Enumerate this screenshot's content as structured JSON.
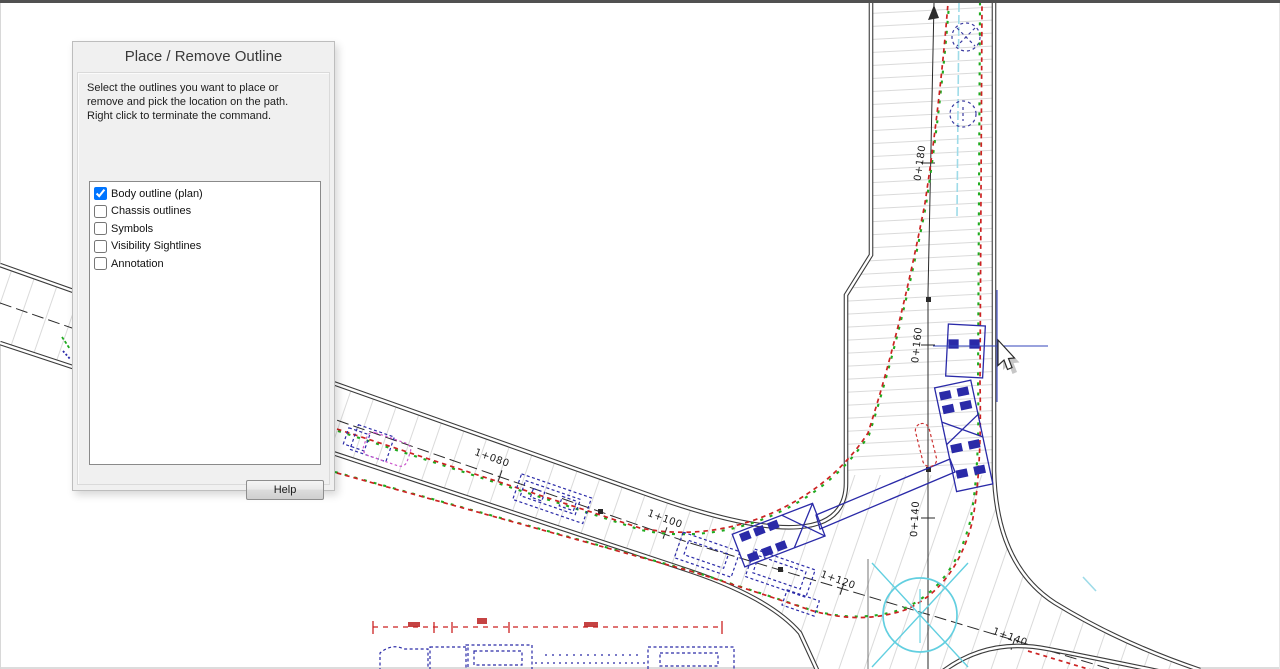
{
  "dialog": {
    "title": "Place / Remove Outline",
    "instructions": {
      "line1": "Select the outlines you want to place or",
      "line2": "remove and pick the location on the path.",
      "line3": "Right click to terminate the command."
    },
    "options": [
      {
        "label": "Body outline (plan)",
        "checked": true
      },
      {
        "label": "Chassis outlines",
        "checked": false
      },
      {
        "label": "Symbols",
        "checked": false
      },
      {
        "label": "Visibility Sightlines",
        "checked": false
      },
      {
        "label": "Annotation",
        "checked": false
      }
    ],
    "help_label": "Help"
  },
  "drawing": {
    "station_labels_vertical": [
      {
        "label": "0+180"
      },
      {
        "label": "0+160"
      },
      {
        "label": "0+140"
      }
    ],
    "station_labels_diagonal": [
      {
        "label": "1+080"
      },
      {
        "label": "1+100"
      },
      {
        "label": "1+120"
      },
      {
        "label": "1+140"
      }
    ],
    "colors": {
      "swept_path_red": "#cc2222",
      "body_outline_green": "#1faa1f",
      "vehicle_blue": "#2a2aa8",
      "path_centerline_cyan": "#9edbe8",
      "turning_circle_cyan": "#62cfe0",
      "ghost_outline_magenta": "#cc55cc",
      "road_edge_gray": "#3b3b3b",
      "hatch_gray": "#dadada"
    }
  }
}
